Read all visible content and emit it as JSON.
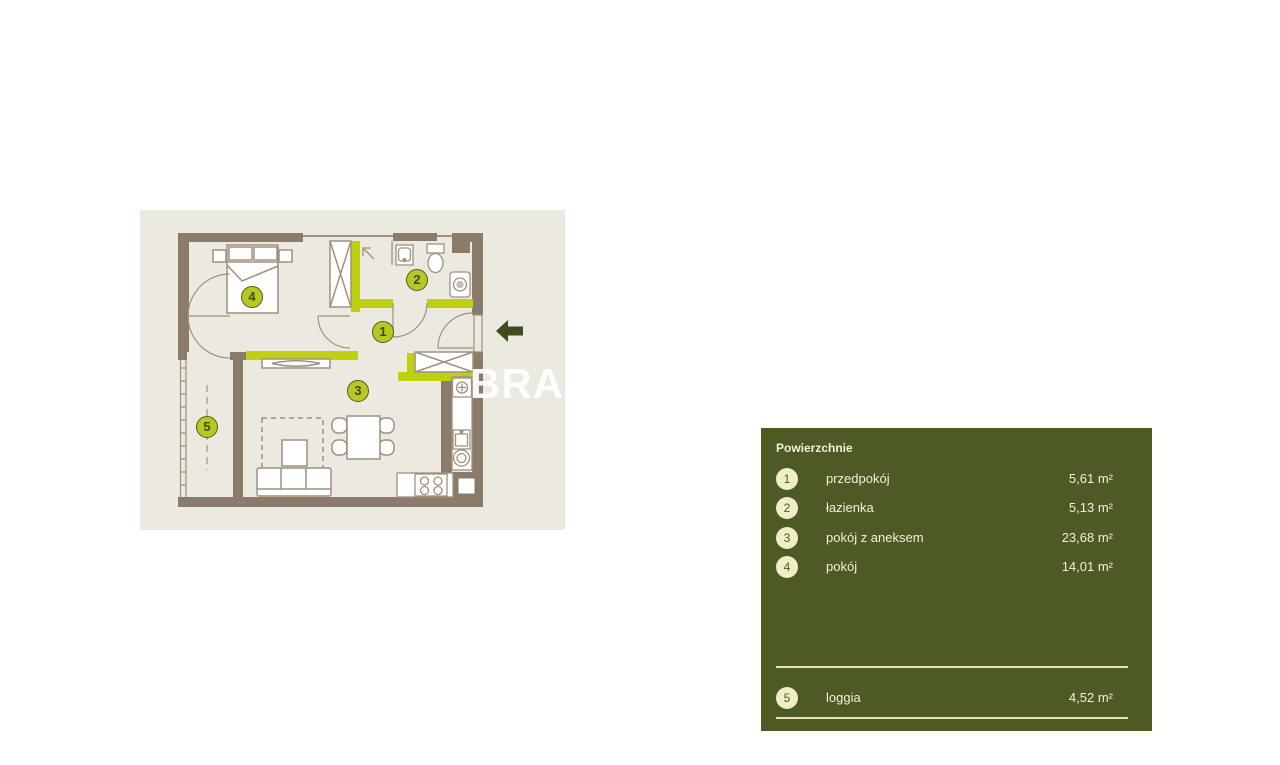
{
  "colors": {
    "plan_background": "#ece9e1",
    "wall": "#8a7b6b",
    "furniture_line": "#9f917f",
    "highlight_lime": "#bfd011",
    "badge_fill": "#b6c822",
    "badge_border": "#565c17",
    "panel_background": "#4d5a23",
    "panel_circle": "#f0eec6",
    "panel_text": "#f2f0da",
    "divider": "#e6e3b0",
    "entry_arrow": "#404c1e",
    "watermark": "#ffffff"
  },
  "floorplan": {
    "watermark_text": "BRAC",
    "badges": [
      {
        "num": "1"
      },
      {
        "num": "2"
      },
      {
        "num": "3"
      },
      {
        "num": "4"
      },
      {
        "num": "5"
      }
    ]
  },
  "legend": {
    "title": "Powierzchnie",
    "items": [
      {
        "num": "1",
        "label": "przedpokój",
        "area": "5,61 m²"
      },
      {
        "num": "2",
        "label": "łazienka",
        "area": "5,13 m²"
      },
      {
        "num": "3",
        "label": "pokój z aneksem",
        "area": "23,68 m²"
      },
      {
        "num": "4",
        "label": "pokój",
        "area": "14,01 m²"
      },
      {
        "num": "5",
        "label": "loggia",
        "area": "4,52 m²"
      }
    ]
  }
}
